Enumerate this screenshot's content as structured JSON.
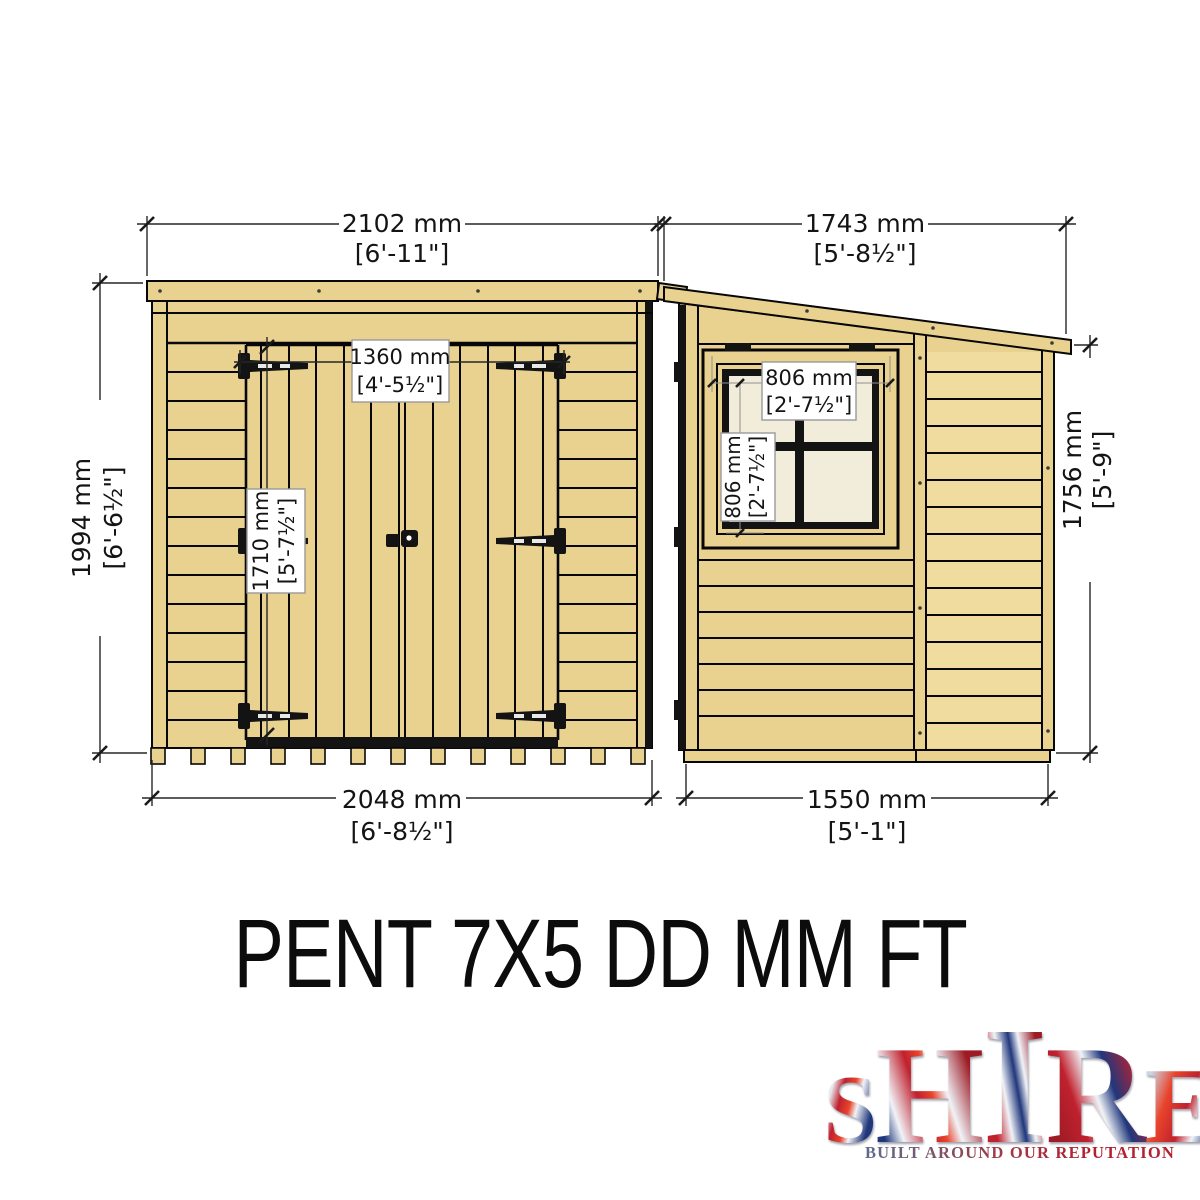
{
  "colors": {
    "wood": "#e9d28f",
    "wood_light": "#f4e3ab",
    "glass": "#f2edda",
    "logo_red": "#c0212e",
    "logo_blue": "#20377b",
    "logo_silver": "#ccd5e2"
  },
  "title": "PENT 7X5 DD MM FT",
  "front_view": {
    "overall_width": {
      "mm": "2102 mm",
      "ft": "[6'-11\"]"
    },
    "overall_height": {
      "mm": "1994 mm",
      "ft": "[6'-6½\"]"
    },
    "base_width": {
      "mm": "2048 mm",
      "ft": "[6'-8½\"]"
    },
    "door_width": {
      "mm": "1360 mm",
      "ft": "[4'-5½\"]"
    },
    "door_height": {
      "mm": "1710 mm",
      "ft": "[5'-7½\"]"
    }
  },
  "side_view": {
    "overall_depth": {
      "mm": "1743 mm",
      "ft": "[5'-8½\"]"
    },
    "eaves_height": {
      "mm": "1756 mm",
      "ft": "[5'-9\"]"
    },
    "base_depth": {
      "mm": "1550 mm",
      "ft": "[5'-1\"]"
    },
    "window_width": {
      "mm": "806 mm",
      "ft": "[2'-7½\"]"
    },
    "window_height": {
      "mm": "806 mm",
      "ft": "[2'-7½\"]"
    }
  },
  "logo": {
    "letters": [
      "S",
      "H",
      "I",
      "R",
      "E"
    ],
    "tagline": "BUILT AROUND OUR REPUTATION"
  }
}
